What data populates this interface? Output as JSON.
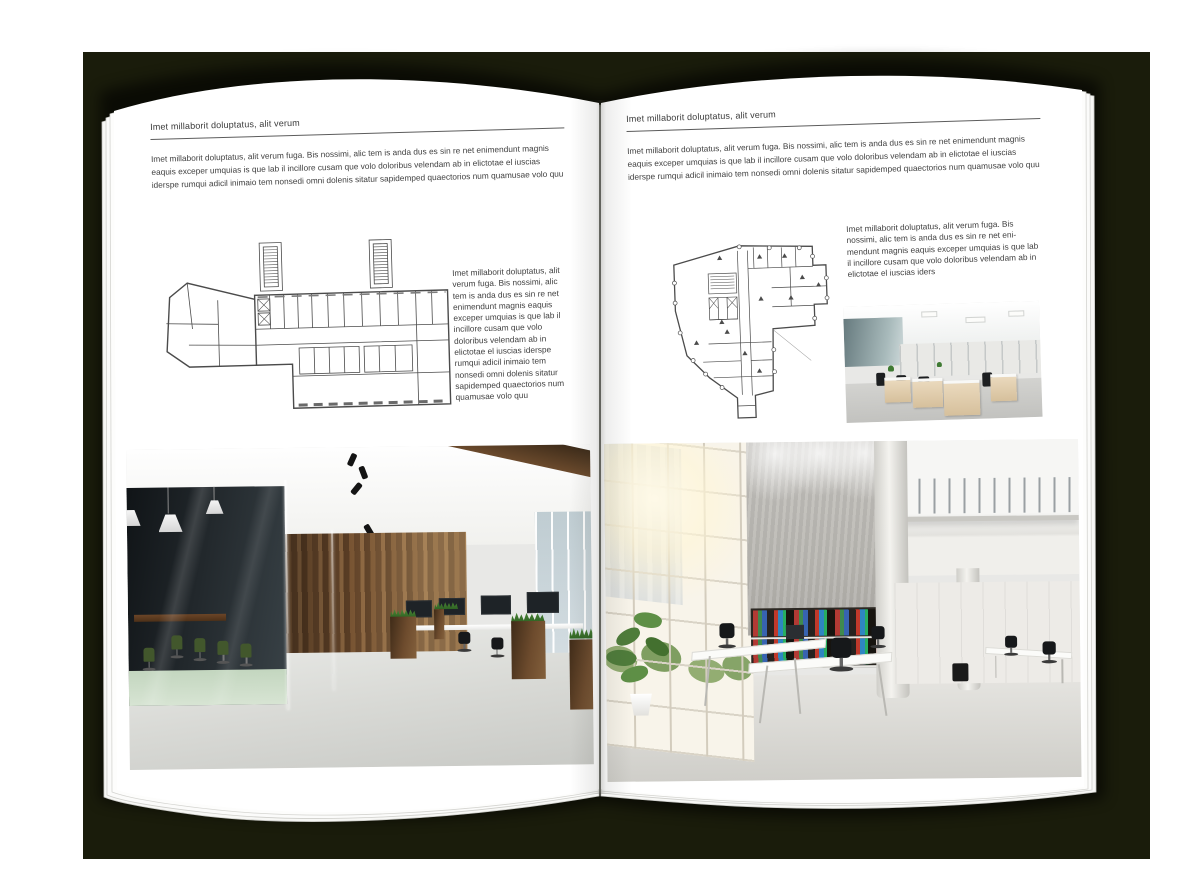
{
  "backdrop": {
    "color": "#1a1c0b"
  },
  "left_page": {
    "header": "Imet millaborit doluptatus, alit verum",
    "intro": "Imet millaborit doluptatus, alit verum fuga. Bis nossimi, alic tem is anda dus es sin re net enimendunt magnis eaquis exceper umquias is que lab il incillore cusam que volo doloribus velendam ab in elictotae el iuscias iderspe rumqui adicil inimaio tem nonsedi omni dolenis sitatur sapidemped quaectorios num quamusae volo quu",
    "figure_caption": "Imet millaborit doluptatus, alit verum fuga. Bis nossimi, alic tem is anda dus es sin re net enimendunt magnis eaquis exceper umquias is que lab il incillore cusam que volo doloribus velendam ab in elictotae el iuscias iderspe rumqui adicil inimaio tem nonsedi omni dolenis sitatur sapidemped quaectorios num quamusae volo quu"
  },
  "right_page": {
    "header": "Imet millaborit doluptatus, alit verum",
    "intro": "Imet millaborit doluptatus, alit verum fuga. Bis nossimi, alic tem is anda dus es sin re net enimendunt magnis eaquis exceper umquias is que lab il incillore cusam que volo doloribus velendam ab in elictotae el iuscias iderspe rumqui adicil inimaio tem nonsedi omni dolenis sitatur sapidemped quaectorios num quamusae volo quu",
    "figure_caption": "Imet millaborit doluptatus, alit verum fuga. Bis nossimi, alic tem is anda dus es sin re net eni-mendunt magnis eaquis exceper umquias is que lab il incillore cusam que volo doloribus velendam ab in elictotae el iuscias iders"
  }
}
